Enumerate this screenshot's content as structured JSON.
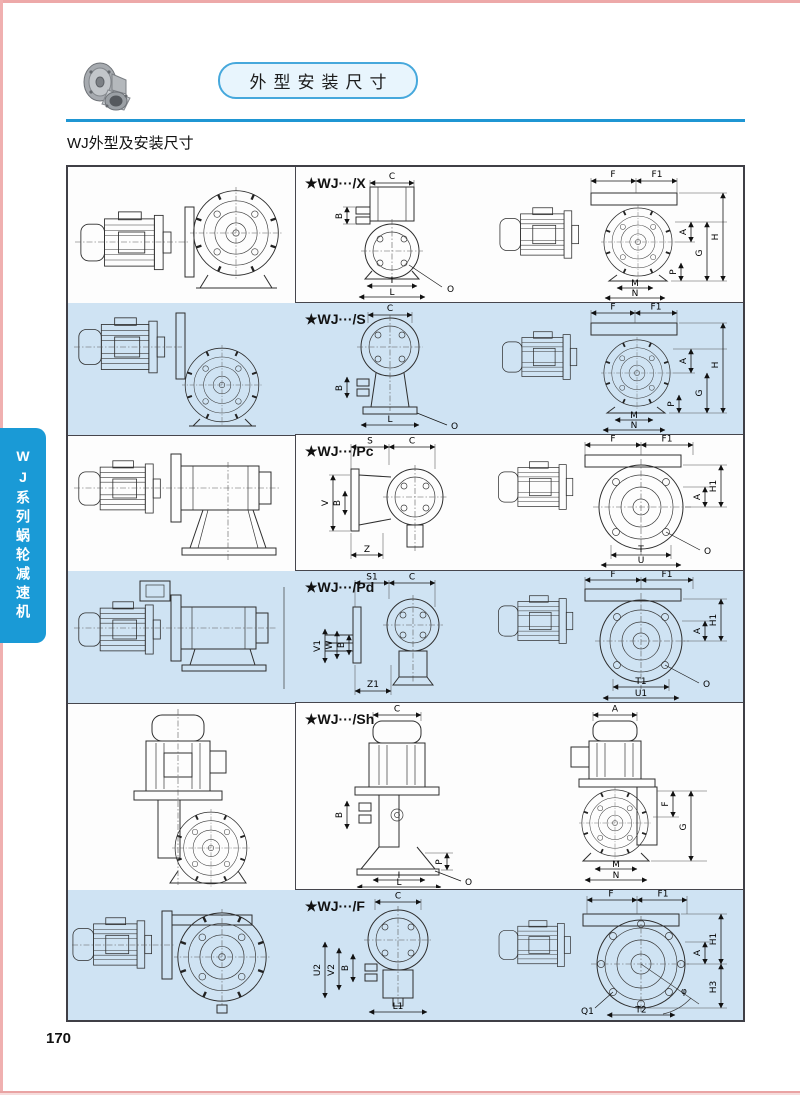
{
  "page": {
    "number": "170"
  },
  "header": {
    "badge": "外型安装尺寸",
    "subtitle": "WJ外型及安装尺寸"
  },
  "sidebar": {
    "label": "WJ系列蜗轮减速机"
  },
  "colors": {
    "accent_blue": "#1a9ad6",
    "row_alt_blue": "#cfe3f3",
    "pill_fill": "#e8f5fd",
    "pill_border": "#46a8dc",
    "edge_pink": "#eda9a9"
  },
  "rows": [
    {
      "label": "★WJ···/X",
      "dims_a": [
        "C",
        "B",
        "I",
        "L",
        "O"
      ],
      "dims_b": [
        "F",
        "F1",
        "A",
        "G",
        "H",
        "P",
        "M",
        "N"
      ]
    },
    {
      "label": "★WJ···/S",
      "dims_a": [
        "C",
        "B",
        "L",
        "O"
      ],
      "dims_b": [
        "F",
        "F1",
        "A",
        "H",
        "G",
        "P",
        "M",
        "N"
      ]
    },
    {
      "label": "★WJ···/Pc",
      "dims_a": [
        "S",
        "C",
        "V",
        "B",
        "Z"
      ],
      "dims_b": [
        "F",
        "F1",
        "A",
        "H1",
        "T",
        "U",
        "O"
      ]
    },
    {
      "label": "★WJ···/Pd",
      "dims_a": [
        "S1",
        "C",
        "V1",
        "W",
        "B",
        "Z1"
      ],
      "dims_b": [
        "F",
        "F1",
        "A",
        "H1",
        "T1",
        "U1",
        "O"
      ]
    },
    {
      "label": "★WJ···/Sh",
      "dims_a": [
        "C",
        "B",
        "P",
        "I",
        "L",
        "O"
      ],
      "dims_b": [
        "A",
        "F",
        "G",
        "M",
        "N"
      ]
    },
    {
      "label": "★WJ···/F",
      "dims_a": [
        "C",
        "U2",
        "V2",
        "B",
        "L1"
      ],
      "dims_b": [
        "F",
        "F1",
        "H1",
        "A",
        "H3",
        "Q1",
        "T2",
        "φ"
      ]
    }
  ]
}
